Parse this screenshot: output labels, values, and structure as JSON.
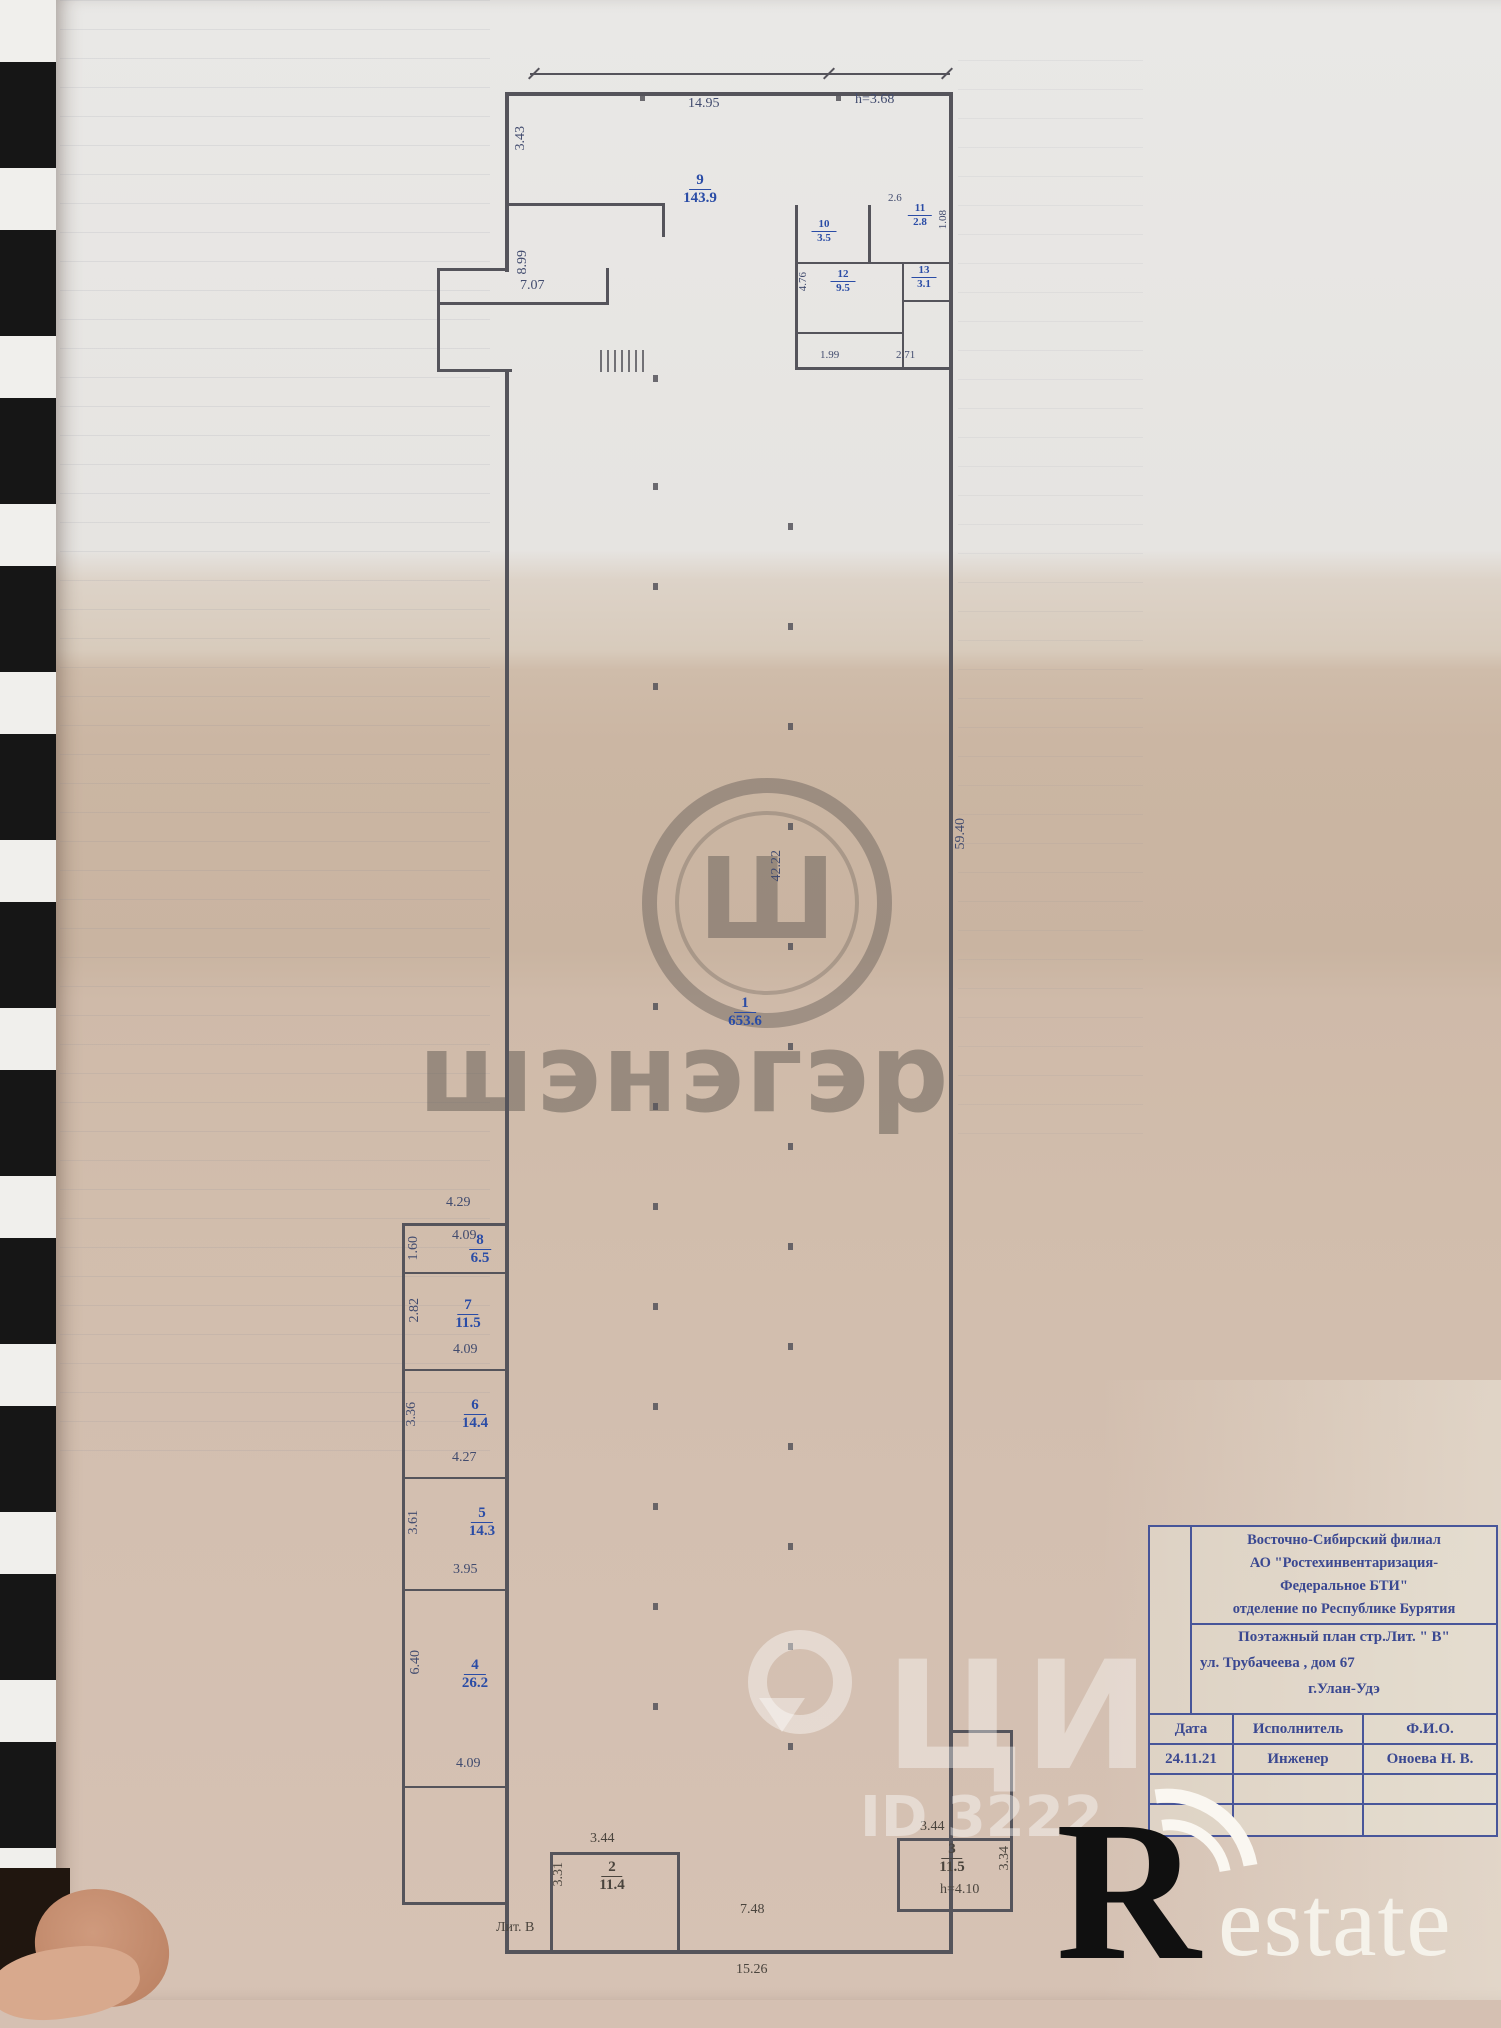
{
  "plan": {
    "rooms": {
      "r1": {
        "num": "1",
        "area": "653.6"
      },
      "r2": {
        "num": "2",
        "area": "11.4"
      },
      "r3": {
        "num": "3",
        "area": "11.5"
      },
      "r4": {
        "num": "4",
        "area": "26.2"
      },
      "r5": {
        "num": "5",
        "area": "14.3"
      },
      "r6": {
        "num": "6",
        "area": "14.4"
      },
      "r7": {
        "num": "7",
        "area": "11.5"
      },
      "r8": {
        "num": "8",
        "area": "6.5"
      },
      "r9": {
        "num": "9",
        "area": "143.9"
      },
      "r10": {
        "num": "10",
        "area": "3.5"
      },
      "r11": {
        "num": "11",
        "area": "2.8"
      },
      "r12": {
        "num": "12",
        "area": "9.5"
      },
      "r13": {
        "num": "13",
        "area": "3.1"
      }
    },
    "dims": {
      "top_width": "14.95",
      "top_height": "h=3.68",
      "left_a": "3.43",
      "left_b": "8.99",
      "lobby_w": "7.07",
      "wc_w": "2.6",
      "wc_d": "1.08",
      "corr_d": "4.76",
      "wc_b1": "1.99",
      "wc_b2": "2.71",
      "hall_len": "59.40",
      "hall_mid": "42.22",
      "col_top": "4.29",
      "r8_w": "4.09",
      "r8_d": "1.60",
      "r7_d": "2.82",
      "r7_w": "4.09",
      "r6_d": "3.36",
      "r6_w": "4.27",
      "r5_d": "3.61",
      "r5_w": "3.95",
      "r4_d": "6.40",
      "r4_w": "4.09",
      "r2_w": "3.44",
      "r2_d": "3.31",
      "r3_w": "3.44",
      "r3_d": "3.34",
      "bot_mid": "7.48",
      "bot_total": "15.26",
      "r3_h": "h=4.10",
      "litera": "Лит. В"
    }
  },
  "title_block": {
    "org_line1": "Восточно-Сибирский филиал",
    "org_line2": "АО \"Ростехинвентаризация-",
    "org_line3": "Федеральное БТИ\"",
    "org_line4": "отделение по  Республике Бурятия",
    "doc_line": "Поэтажный план стр.Лит. \" В\"",
    "address": "ул. Трубачеева , дом 67",
    "city": "г.Улан-Удэ",
    "col_date": "Дата",
    "col_role": "Исполнитель",
    "col_name": "Ф.И.О.",
    "val_date": "24.11.21",
    "val_role": "Инженер",
    "val_name": "Оноева Н. В."
  },
  "watermarks": {
    "center_logo_letter": "Ш",
    "center_text": "шэнэгэр",
    "cian_letters": "ЦИ",
    "cian_id": "ID 3222",
    "restate_r": "R",
    "restate_rest": "estate"
  }
}
